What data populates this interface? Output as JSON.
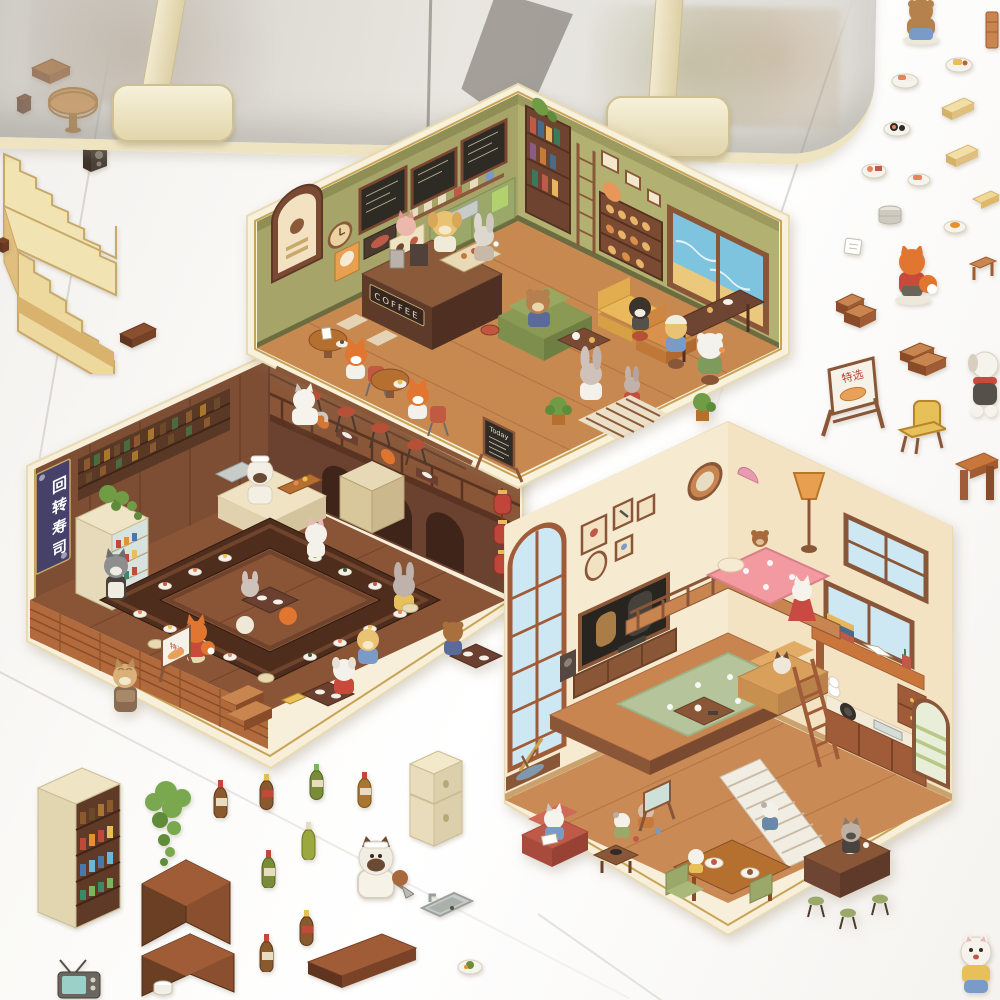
{
  "photo": {
    "subject": "Sheets of die-cut stickers on a white desk: three hexagonal isometric animal dollhouse rooms (coffee shop, conveyor sushi bar, loft living room) plus loose furniture, bottle and food stickers, under the edge of a clear plastic storage box held by two cream clips",
    "storage_box_clips": 2
  },
  "labels": {
    "coffee_sign": "COFFEE",
    "today_board": "Today",
    "sushi_banner": "回转寿司",
    "scene_sign": "特选",
    "sticker_sign": "特选"
  },
  "scenes": [
    {
      "id": "coffee-shop",
      "shape": "hexagonal isometric room sticker",
      "wall_color": "#a6a468",
      "floor_color": "#c78950",
      "items": [
        "three chalkboard menus",
        "wall clock",
        "arched coffee poster",
        "cat poster",
        "espresso counter with COFFEE sign",
        "pastry display case",
        "golden retriever barista",
        "pink cat barista",
        "white rabbit with coffee",
        "green sofa with brown bear",
        "yellow armchair",
        "orange armchair",
        "round tables with fox customers",
        "red cafe chairs",
        "bar stools along rail",
        "Today menu chalkboard",
        "bookshelf with ladder",
        "pastry shelf",
        "beach-view window",
        "gray rabbit in dress",
        "small rabbit in red sweater",
        "polar bear snacking",
        "black and white dog on stool",
        "potted plants",
        "striped floor mat",
        "white cat peeking over edge"
      ]
    },
    {
      "id": "conveyor-sushi-bar",
      "shape": "hexagonal isometric room sticker",
      "wall_color": "#7d4e33",
      "floor_color": "#8a5436",
      "items": [
        "vertical navy banner reading 回转寿司",
        "liquor bottle shelf",
        "drinks display fridge with hanging ivy",
        "siamese chef with sushi boat",
        "steel sink",
        "conveyor belt ring with white sushi plates",
        "cream stools",
        "low inner tables",
        "white cat, fox, husky waiter, gray rabbit, golden dog, brown bear, white dog diners",
        "yellow chairs",
        "special-menu A-frame sign",
        "wooden front deck",
        "steps",
        "tabby cat in apron",
        "upper mezzanine with dining foxes",
        "arched wall niches",
        "red lantern string"
      ]
    },
    {
      "id": "loft-living-room",
      "shape": "tall hexagonal isometric room sticker",
      "wall_color": "#f6ead0",
      "floor_color": "#c98a55",
      "items": [
        "tall arched window",
        "picture frame gallery",
        "round wooden mirror",
        "loft bed with pink heart blanket",
        "teddy bear",
        "pink wall lamp",
        "TV playing cat movie",
        "speaker",
        "media console",
        "telescope on wall platform",
        "bookshelf",
        "desk with book stack and window",
        "green office chair",
        "drawer unit",
        "orange floor lamp",
        "white cat in red dress",
        "tan sofa with siamese cat",
        "coffee table",
        "sage flower rug",
        "wooden ladder",
        "white staircase with climbing cat",
        "red armchair with reading cat",
        "playing kittens",
        "dining table with plates",
        "green chairs",
        "kitchen counter with sink and stove",
        "cooking cat",
        "green stools",
        "arched shuttered window"
      ]
    }
  ],
  "loose_stickers": [
    "small drawer chest",
    "dark wood block",
    "round wooden table",
    "speaker",
    "large cream staircase",
    "wood block",
    "wood plank",
    "bottle display cabinet",
    "hanging ivy plant",
    "sauce bottles",
    "sake bottles",
    "cream fridge",
    "siamese chef cat with knife",
    "kitchen sink",
    "corner shelf piece",
    "corner shelf piece",
    "long wood plank",
    "retro tv",
    "white cup",
    "plate of food",
    "bear seen from behind",
    "wood strip",
    "sushi plate",
    "tamago plate",
    "tatami mats",
    "bread slices",
    "maki plate",
    "onigiri plate",
    "steamer pot",
    "paper note",
    "fox seen from behind",
    "wooden steps",
    "side table",
    "special-menu a-frame sign",
    "wide wooden steps",
    "yellow chair",
    "white dog with red scarf",
    "sturdy wooden table",
    "white cat in yellow shirt"
  ],
  "palette": {
    "sticker_border": "#f6edd6",
    "gold_line": "#c9a355",
    "cafe_olive": "#a6a468",
    "wood": "#c98a55",
    "counter_brown": "#5d3a2a",
    "banner_navy": "#454169",
    "blanket_pink": "#f2989e",
    "rug_sage": "#b5c49a",
    "window_blue": "#7ec4de",
    "clip_cream": "#f3edd3"
  }
}
